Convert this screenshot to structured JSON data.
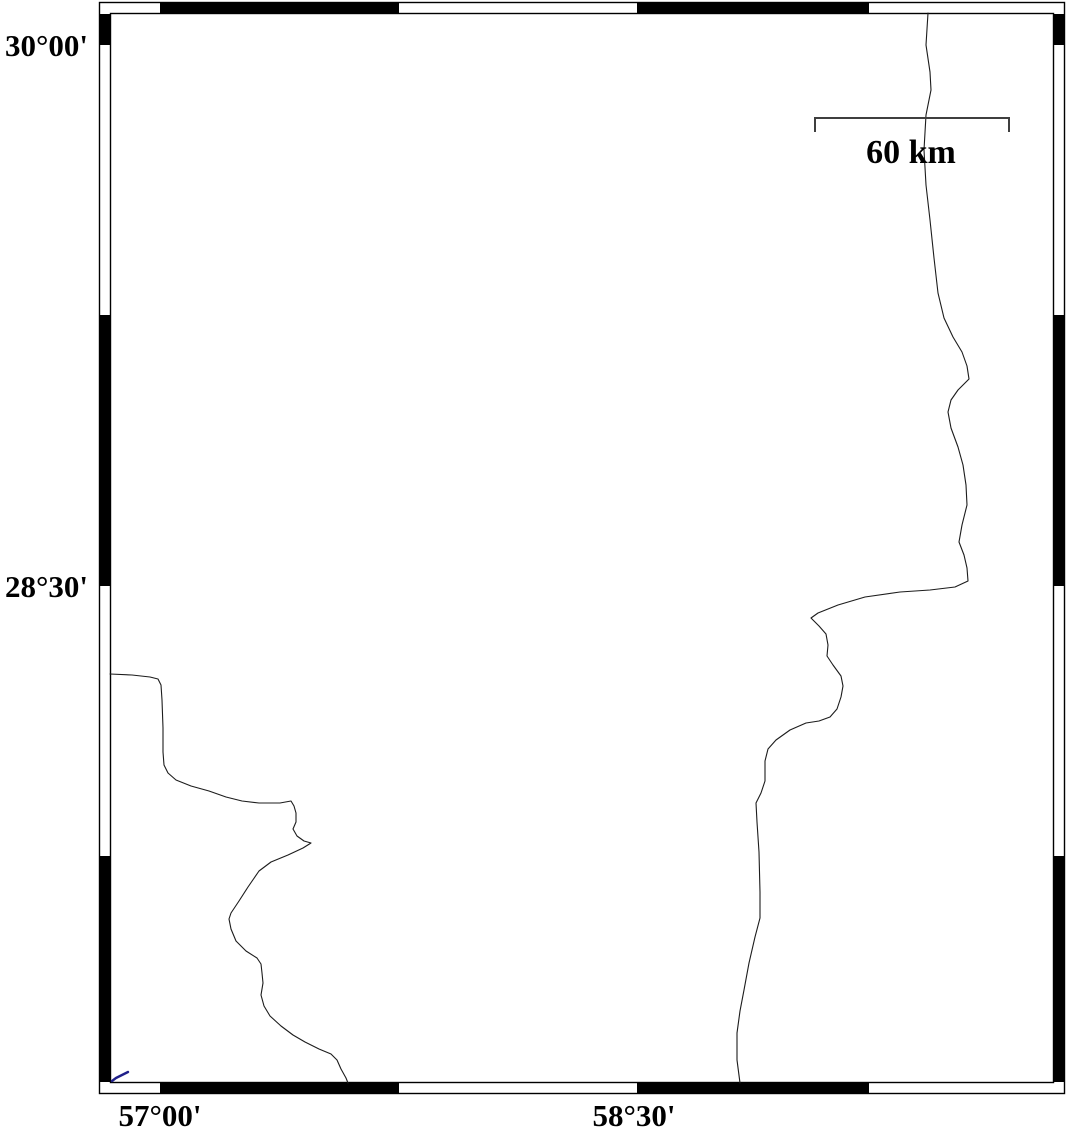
{
  "map": {
    "frame": {
      "latitude_annotations": [
        {
          "label": "30°00'"
        },
        {
          "label": "28°30'"
        }
      ],
      "longitude_annotations": [
        {
          "label": "57°00'"
        },
        {
          "label": "58°30'"
        }
      ]
    },
    "scale_bar": {
      "label": "60 km"
    },
    "colors": {
      "frame_ink": "#000000",
      "boundary_line": "#1c1c1c",
      "scale_bar": "#3f3f3f",
      "river": "#20208a",
      "background": "#ffffff"
    }
  }
}
